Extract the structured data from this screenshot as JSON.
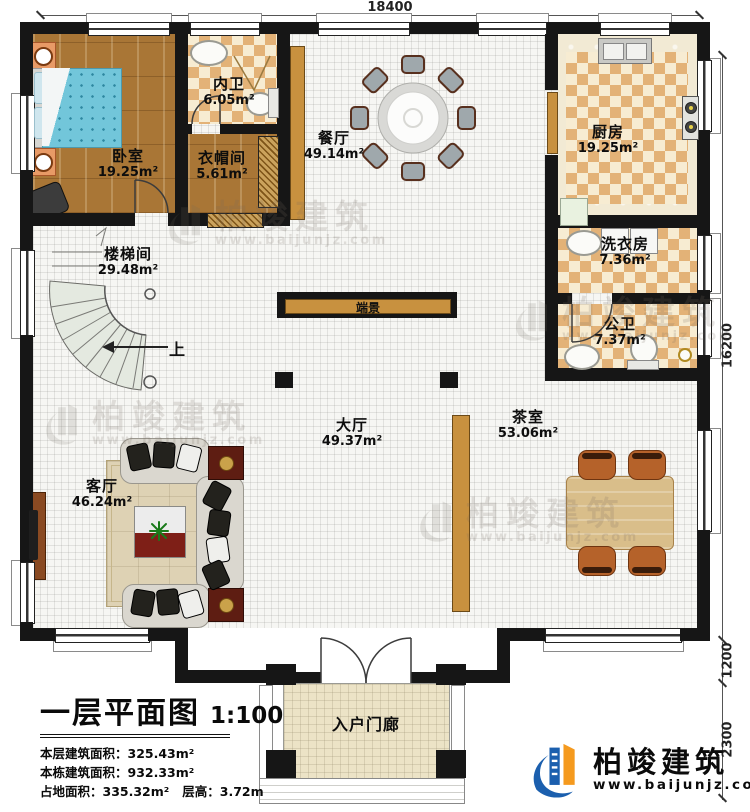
{
  "plan": {
    "title": "一层平面图",
    "scale": "1:100",
    "stats_lines": [
      "本层建筑面积：325.43m²",
      "本栋建筑面积：932.33m²",
      "占地面积：335.32m²   层高：3.72m"
    ]
  },
  "dimensions": {
    "top": "18400",
    "right_upper": "16200",
    "right_mid": "1200",
    "right_lower": "2300"
  },
  "rooms": {
    "bedroom": {
      "name": "卧室",
      "area": "19.25m²"
    },
    "inner_bath": {
      "name": "内卫",
      "area": "6.05m²"
    },
    "cloakroom": {
      "name": "衣帽间",
      "area": "5.61m²"
    },
    "dining": {
      "name": "餐厅",
      "area": "49.14m²"
    },
    "kitchen": {
      "name": "厨房",
      "area": "19.25m²"
    },
    "laundry": {
      "name": "洗衣房",
      "area": "7.36m²"
    },
    "public_bath": {
      "name": "公卫",
      "area": "7.37m²"
    },
    "stairwell": {
      "name": "楼梯间",
      "area": "29.48m²"
    },
    "hall": {
      "name": "大厅",
      "area": "49.37m²"
    },
    "tea_room": {
      "name": "茶室",
      "area": "53.06m²"
    },
    "living_room": {
      "name": "客厅",
      "area": "46.24m²"
    },
    "porch": {
      "name": "入户门廊"
    }
  },
  "annotations": {
    "end_view": "端景",
    "stairs_up": "上"
  },
  "branding": {
    "company": "柏竣建筑",
    "website": "www.baijunjz.com"
  },
  "watermark": {
    "company": "柏竣建筑",
    "website": "www.baijunjz.com"
  },
  "colors": {
    "wall": "#161616",
    "wood_floor": "#a97636",
    "checker_tan": "#e3b277",
    "checker_cream": "#f7ecd2",
    "accent_wood": "#c8913f",
    "logo_blue": "#1b5fae",
    "logo_orange": "#f59a1e"
  }
}
